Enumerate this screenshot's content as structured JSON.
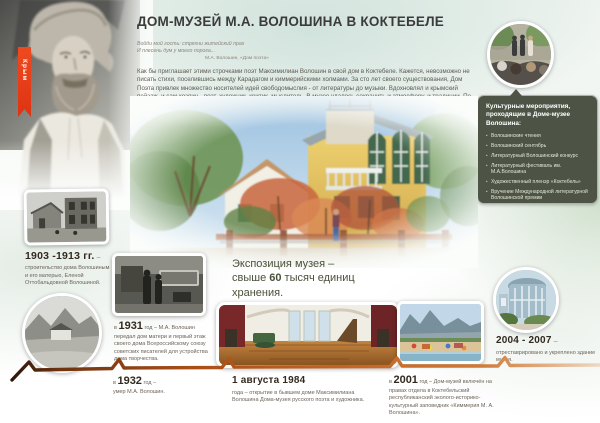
{
  "ribbon": {
    "label": "Крым"
  },
  "header": {
    "title": "ДОМ-МУЗЕЙ М.А. ВОЛОШИНА В КОКТЕБЕЛЕ",
    "epigraph_line1": "Войди мой гость: стряхни житейский прах",
    "epigraph_line2": "И плесень дум у моего порога...",
    "epigraph_attribution": "М.А. Волошин, «Дом поэта»"
  },
  "intro": {
    "text": "Как бы приглашает этими строчками поэт Максимилиан Волошин в свой дом в Коктебеле. Кажется, невозможно не писать стихи, поселившись между Карадагом и киммерийскими холмами. За сто лет своего существования, Дом Поэта привлек множество носителей идей свободомыслия - от литературы до музыки. Вдохновлял и крымский пейзаж, и сам хозяин - поэт, художник, критик, мыслитель. В музее удалось сохранить и атмосферу, и традиции. По-прежнему, людей искусства привлекают Волошинские чтения, Литературные Волошинские конкурс и фестиваль, Художественный пленэр. Как и раньше, когда в этом доме бывали Гумилев, Цветаева, Зощенко, Мандельштам..."
  },
  "events_panel": {
    "title": "Культурные мероприятия, проходящие в Доме-музее Волошина:",
    "items": [
      "Волошинские чтения",
      "Волошинский сентябрь",
      "Литературный Волошинский конкурс",
      "Литературный фестиваль им. М.А.Волошина",
      "Художественный пленэр «Коктебель»",
      "Вручение Международной литературной Волошинской премии"
    ]
  },
  "exposition": {
    "line1": "Экспозиция музея –",
    "line2_pre": "свыше ",
    "line2_num": "60",
    "line2_post": " тысяч единиц",
    "line3": "хранения."
  },
  "timeline": {
    "e1903": {
      "year": "1903 -1913 гг.",
      "dash": " –",
      "text": "строительство дома Волошиным и его матерью, Еленой Оттобальдовной Волошиной."
    },
    "e1931": {
      "prefix": "в ",
      "year": "1931",
      "suffix": " год – ",
      "text": "М.А. Волошин передал дом матери и первый этаж своего дома Всероссийскому союзу советских писателей для устройства дома творчества."
    },
    "e1932": {
      "prefix": "в ",
      "year": "1932",
      "suffix": " год – ",
      "text": "умер М.А. Волошин."
    },
    "e1984": {
      "year": "1 августа 1984",
      "text": "года – открытие в бывшем доме Максимилиана Волошина Дома-музея русского поэта и художника."
    },
    "e2001": {
      "prefix": "в ",
      "year": "2001",
      "suffix": " год – ",
      "text": "Дом-музей включён на правах отдела в Коктебельский республиканский эколого-историко-культурный заповедник «Киммерия М. А. Волошина»."
    },
    "e2004": {
      "year": "2004 - 2007",
      "dash": " –",
      "text": "отреставрировано и укреплено здание музея."
    }
  }
}
